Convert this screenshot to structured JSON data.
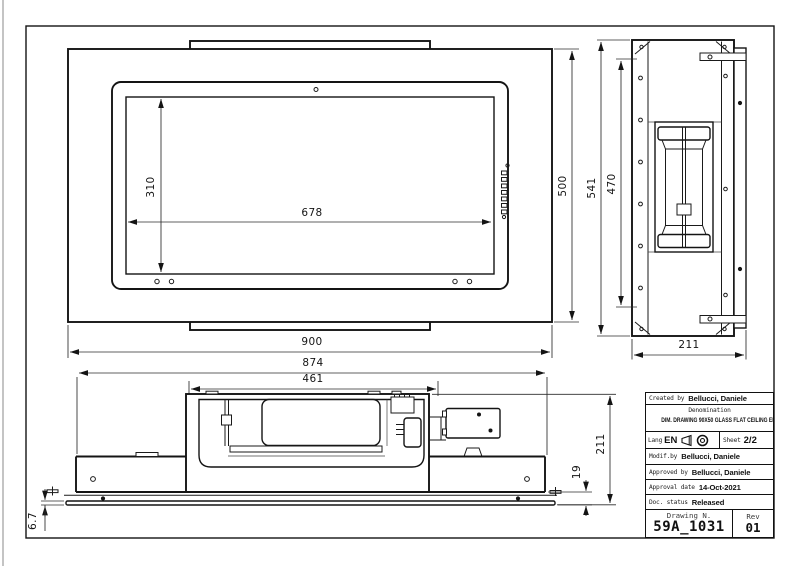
{
  "sheet": {
    "dimensions": {
      "front": {
        "width": "900",
        "height": "500",
        "glass_width": "678",
        "glass_height": "310"
      },
      "side": {
        "overall_height": "541",
        "hole_span": "470",
        "depth": "211"
      },
      "section": {
        "overall_width": "874",
        "duct_box_width": "461",
        "total_height": "211",
        "body_height": "19",
        "glass_thickness": "6.7"
      }
    },
    "title_block": {
      "created_by_label": "Created by",
      "created_by": "Bellucci, Daniele",
      "denomination_label": "Denomination",
      "denomination": "DIM. DRAWING 90X50 GLASS FLAT CEILING EMC",
      "lang_label": "Lang",
      "lang_value": "EN",
      "sheet_label": "Sheet",
      "sheet_value": "2/2",
      "modif_label": "Modif.by",
      "modif_by": "Bellucci, Daniele",
      "approved_label": "Approved by",
      "approved_by": "Bellucci, Daniele",
      "approval_date_label": "Approval date",
      "approval_date": "14-Oct-2021",
      "doc_status_label": "Doc. status",
      "doc_status": "Released",
      "drawing_n_label": "Drawing N.",
      "drawing_number": "59A_1031",
      "rev_label": "Rev",
      "rev_value": "01",
      "icons": [
        "first-angle-projection-icon",
        "projection-view-icon"
      ],
      "line_color": "#141414"
    }
  }
}
